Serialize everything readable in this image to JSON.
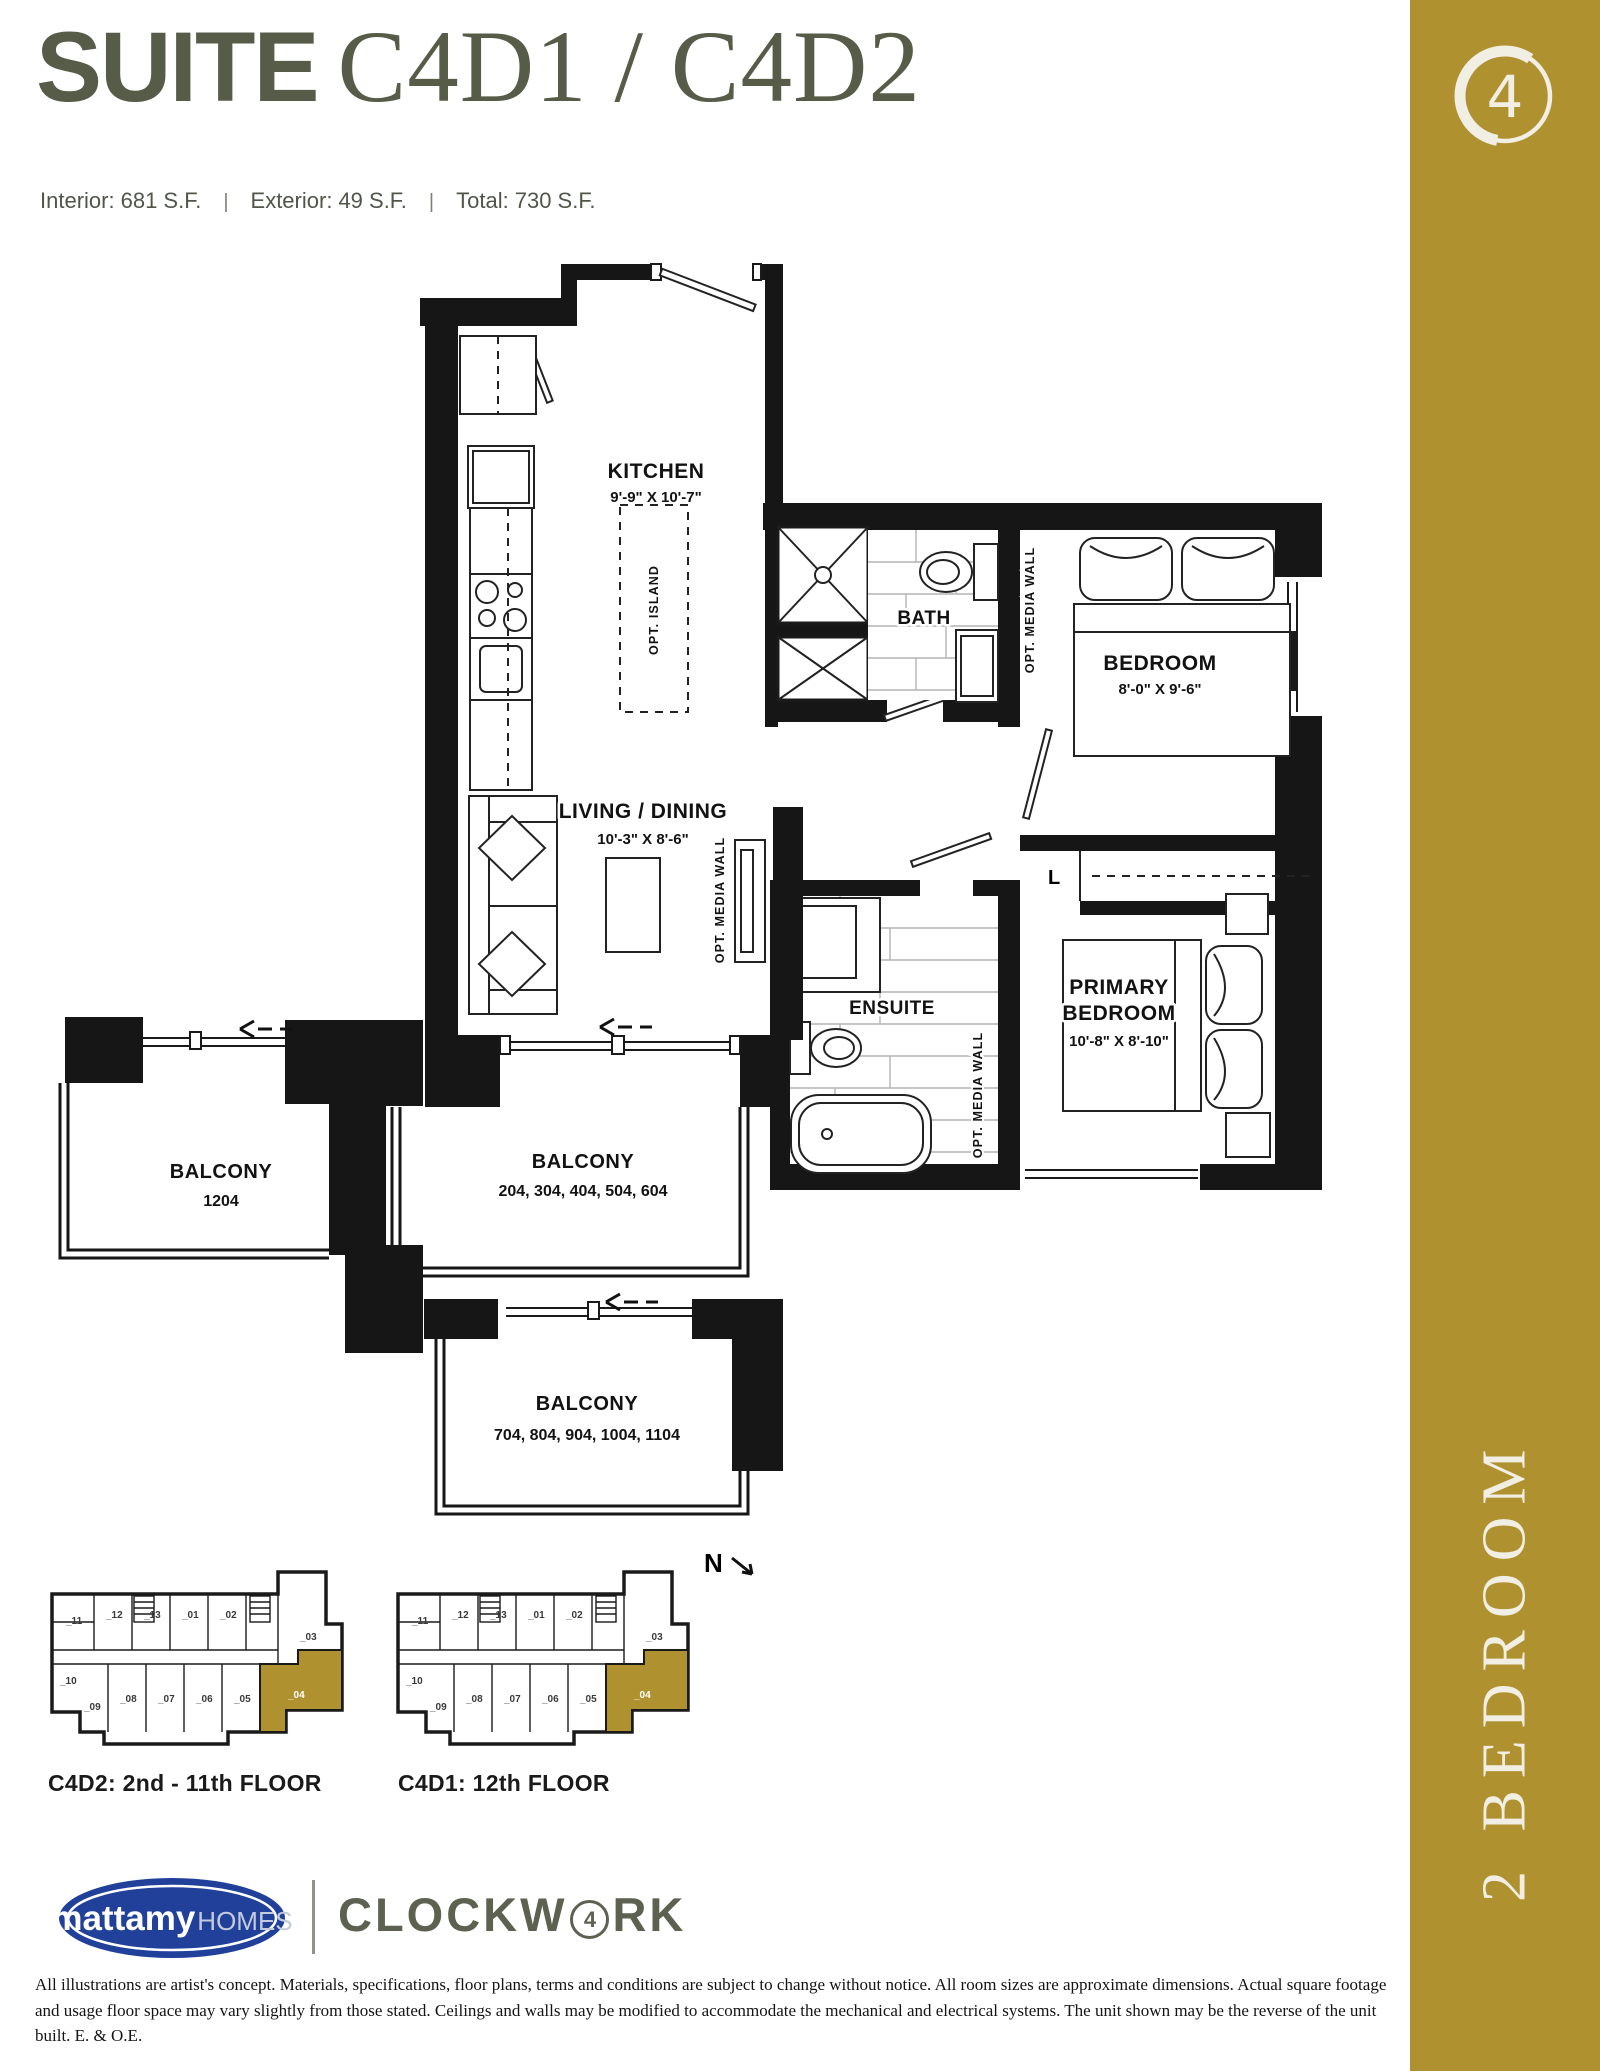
{
  "page": {
    "background": "#ffffff"
  },
  "header": {
    "title_prefix": "SUITE",
    "title_suites": "C4D1 / C4D2",
    "separator": "|",
    "stats": [
      {
        "label": "Interior:",
        "value": "681 S.F."
      },
      {
        "label": "Exterior:",
        "value": "49 S.F."
      },
      {
        "label": "Total:",
        "value": "730 S.F."
      }
    ]
  },
  "sidebar": {
    "badge_number": "4",
    "category_label": "2 BEDROOM",
    "bg_color": "#AF912F",
    "text_color": "#F1EEE4"
  },
  "floorplan": {
    "rooms": {
      "kitchen": {
        "name": "KITCHEN",
        "dims": "9'-9\" X 10'-7\""
      },
      "living": {
        "name": "LIVING / DINING",
        "dims": "10'-3\" X 8'-6\""
      },
      "bath": {
        "name": "BATH"
      },
      "ensuite": {
        "name": "ENSUITE"
      },
      "bedroom": {
        "name": "BEDROOM",
        "dims": "8'-0\" X 9'-6\""
      },
      "primary": {
        "line1": "PRIMARY",
        "line2": "BEDROOM",
        "dims": "10'-8\" X 8'-10\""
      }
    },
    "annotations": {
      "opt_island": "OPT. ISLAND",
      "opt_media_wall": "OPT. MEDIA WALL",
      "linen": "L",
      "north": "N"
    },
    "balconies": [
      {
        "label": "BALCONY",
        "units": "1204"
      },
      {
        "label": "BALCONY",
        "units": "204, 304, 404, 504, 604"
      },
      {
        "label": "BALCONY",
        "units": "704, 804, 904, 1004, 1104"
      }
    ]
  },
  "keyplates": {
    "highlight_color": "#AF912F",
    "unit_labels": {
      "u11": "_11",
      "u12": "_12",
      "u13": "_13",
      "u01": "_01",
      "u02": "_02",
      "u03": "_03",
      "u10": "_10",
      "u09": "_09",
      "u08": "_08",
      "u07": "_07",
      "u06": "_06",
      "u05": "_05",
      "u04": "_04"
    },
    "plates": [
      {
        "caption": "C4D2: 2nd - 11th FLOOR"
      },
      {
        "caption": "C4D1: 12th FLOOR"
      }
    ]
  },
  "footer": {
    "logo": {
      "brand": "mattamy",
      "suffix": "HOMES",
      "ellipse_color": "#20409A"
    },
    "wordmark": {
      "pre": "CLOCKW",
      "circled_number": "4",
      "post": "RK",
      "color": "#5D6150"
    },
    "disclaimer": "All illustrations are artist's concept. Materials, specifications, floor plans, terms and conditions are subject to change without notice. All room sizes are approximate dimensions. Actual square footage and usage floor space may vary slightly from those stated. Ceilings and walls may be modified to accommodate the mechanical and electrical systems. The unit shown may be the reverse of the unit built. E. & O.E."
  }
}
